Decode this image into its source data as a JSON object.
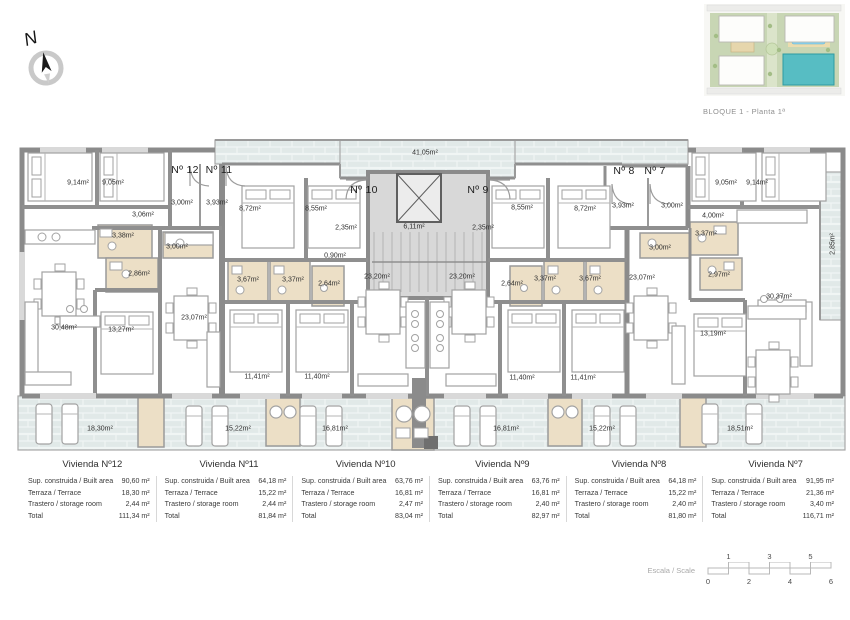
{
  "header": {
    "site_plan_caption": "BLOQUE 1 - Planta 1ª"
  },
  "compass": {
    "letter": "N"
  },
  "plan": {
    "unit_labels": [
      {
        "t": "Nº 12",
        "x": 185,
        "y": 170
      },
      {
        "t": "Nº 11",
        "x": 219,
        "y": 170
      },
      {
        "t": "Nº 10",
        "x": 364,
        "y": 190
      },
      {
        "t": "Nº 9",
        "x": 478,
        "y": 190
      },
      {
        "t": "Nº 8",
        "x": 624,
        "y": 171
      },
      {
        "t": "Nº 7",
        "x": 655,
        "y": 171
      }
    ],
    "room_labels": [
      {
        "t": "41,05m²",
        "x": 425,
        "y": 153
      },
      {
        "t": "9,14m²",
        "x": 78,
        "y": 183
      },
      {
        "t": "9,05m²",
        "x": 113,
        "y": 183
      },
      {
        "t": "3,00m²",
        "x": 182,
        "y": 203
      },
      {
        "t": "3,93m²",
        "x": 217,
        "y": 203
      },
      {
        "t": "3,06m²",
        "x": 143,
        "y": 215
      },
      {
        "t": "3,38m²",
        "x": 123,
        "y": 236
      },
      {
        "t": "3,00m²",
        "x": 177,
        "y": 247
      },
      {
        "t": "2,86m²",
        "x": 139,
        "y": 274
      },
      {
        "t": "8,72m²",
        "x": 250,
        "y": 209
      },
      {
        "t": "8,55m²",
        "x": 316,
        "y": 209
      },
      {
        "t": "2,35m²",
        "x": 346,
        "y": 228
      },
      {
        "t": "0,90m²",
        "x": 335,
        "y": 256
      },
      {
        "t": "6,11m²",
        "x": 414,
        "y": 227
      },
      {
        "t": "23,20m²",
        "x": 377,
        "y": 277
      },
      {
        "t": "3,67m²",
        "x": 248,
        "y": 280
      },
      {
        "t": "3,37m²",
        "x": 293,
        "y": 280
      },
      {
        "t": "2,64m²",
        "x": 329,
        "y": 284
      },
      {
        "t": "11,41m²",
        "x": 257,
        "y": 377
      },
      {
        "t": "11,40m²",
        "x": 317,
        "y": 377
      },
      {
        "t": "30,48m²",
        "x": 64,
        "y": 328
      },
      {
        "t": "13,27m²",
        "x": 121,
        "y": 330
      },
      {
        "t": "23,07m²",
        "x": 194,
        "y": 318
      },
      {
        "t": "18,30m²",
        "x": 100,
        "y": 429
      },
      {
        "t": "15,22m²",
        "x": 238,
        "y": 429
      },
      {
        "t": "16,81m²",
        "x": 335,
        "y": 429
      },
      {
        "t": "2,35m²",
        "x": 483,
        "y": 228
      },
      {
        "t": "23,20m²",
        "x": 462,
        "y": 277
      },
      {
        "t": "2,64m²",
        "x": 512,
        "y": 284
      },
      {
        "t": "3,37m²",
        "x": 545,
        "y": 279
      },
      {
        "t": "3,67m²",
        "x": 590,
        "y": 279
      },
      {
        "t": "11,40m²",
        "x": 522,
        "y": 378
      },
      {
        "t": "11,41m²",
        "x": 583,
        "y": 378
      },
      {
        "t": "16,81m²",
        "x": 506,
        "y": 429
      },
      {
        "t": "15,22m²",
        "x": 602,
        "y": 429
      },
      {
        "t": "18,51m²",
        "x": 740,
        "y": 429
      },
      {
        "t": "8,55m²",
        "x": 522,
        "y": 208
      },
      {
        "t": "8,72m²",
        "x": 585,
        "y": 209
      },
      {
        "t": "3,93m²",
        "x": 623,
        "y": 206
      },
      {
        "t": "3,00m²",
        "x": 672,
        "y": 206
      },
      {
        "t": "3,00m²",
        "x": 660,
        "y": 248
      },
      {
        "t": "23,07m²",
        "x": 642,
        "y": 278
      },
      {
        "t": "9,05m²",
        "x": 726,
        "y": 183
      },
      {
        "t": "9,14m²",
        "x": 757,
        "y": 183
      },
      {
        "t": "4,00m²",
        "x": 713,
        "y": 216
      },
      {
        "t": "3,37m²",
        "x": 706,
        "y": 234
      },
      {
        "t": "2,97m²",
        "x": 719,
        "y": 275
      },
      {
        "t": "30,37m²",
        "x": 779,
        "y": 297
      },
      {
        "t": "13,19m²",
        "x": 713,
        "y": 334
      }
    ],
    "vertical_labels": [
      {
        "t": "2,85m²",
        "x": 833,
        "y": 244
      }
    ]
  },
  "tables": [
    {
      "title": "Vivienda Nº12",
      "rows": [
        [
          "Sup. construida / Built area",
          "90,60 m²"
        ],
        [
          "Terraza / Terrace",
          "18,30 m²"
        ],
        [
          "Trastero / storage room",
          "2,44 m²"
        ],
        [
          "Total",
          "111,34 m²"
        ]
      ]
    },
    {
      "title": "Vivienda Nº11",
      "rows": [
        [
          "Sup. construida / Built area",
          "64,18 m²"
        ],
        [
          "Terraza / Terrace",
          "15,22 m²"
        ],
        [
          "Trastero / storage room",
          "2,44 m²"
        ],
        [
          "Total",
          "81,84 m²"
        ]
      ]
    },
    {
      "title": "Vivienda Nº10",
      "rows": [
        [
          "Sup. construida / Built area",
          "63,76 m²"
        ],
        [
          "Terraza / Terrace",
          "16,81 m²"
        ],
        [
          "Trastero / storage room",
          "2,47 m²"
        ],
        [
          "Total",
          "83,04 m²"
        ]
      ]
    },
    {
      "title": "Vivienda Nº9",
      "rows": [
        [
          "Sup. construida / Built area",
          "63,76 m²"
        ],
        [
          "Terraza / Terrace",
          "16,81 m²"
        ],
        [
          "Trastero / storage room",
          "2,40 m²"
        ],
        [
          "Total",
          "82,97 m²"
        ]
      ]
    },
    {
      "title": "Vivienda Nº8",
      "rows": [
        [
          "Sup. construida / Built area",
          "64,18 m²"
        ],
        [
          "Terraza / Terrace",
          "15,22 m²"
        ],
        [
          "Trastero / storage room",
          "2,40 m²"
        ],
        [
          "Total",
          "81,80 m²"
        ]
      ]
    },
    {
      "title": "Vivienda Nº7",
      "rows": [
        [
          "Sup. construida / Built area",
          "91,95 m²"
        ],
        [
          "Terraza / Terrace",
          "21,36 m²"
        ],
        [
          "Trastero / storage room",
          "3,40 m²"
        ],
        [
          "Total",
          "116,71 m²"
        ]
      ]
    }
  ],
  "scale_bar": {
    "label": "Escala / Scale",
    "marks_top": [
      1,
      3,
      5
    ],
    "marks_bottom": [
      0,
      2,
      4,
      6
    ]
  }
}
